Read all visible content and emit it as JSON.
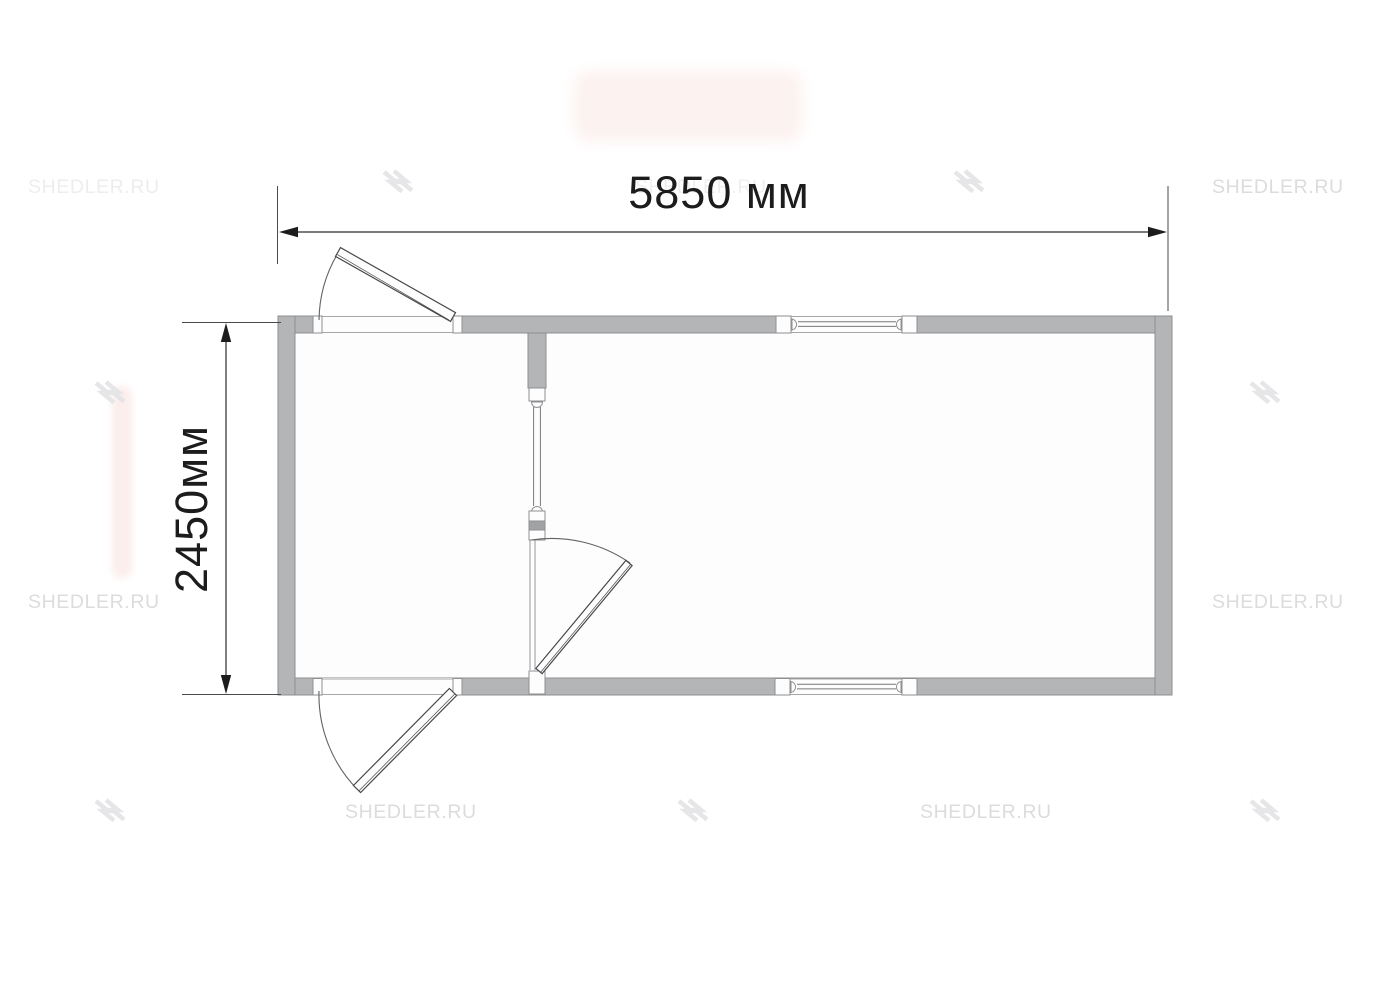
{
  "page": {
    "background_color": "#ffffff"
  },
  "watermark": {
    "text": "SHEDLER.RU",
    "text_color": "#dcdcdc",
    "logo_icon": "shedler-logo-icon",
    "logo_color": "#e4e4e6"
  },
  "dimensions": {
    "width_label": "5850 мм",
    "height_label": "2450мм",
    "color": "#1c1c1c"
  },
  "plan": {
    "wall_fill": "#b3b5b6",
    "wall_stroke": "#8e9092",
    "floor_fill": "#fdfdfd",
    "door_line_color": "#46484a",
    "arc_color": "#606264",
    "glazing_color": "#77797b",
    "rooms": [
      {
        "name": "left-room"
      },
      {
        "name": "right-room"
      }
    ],
    "exterior_door_count": 2,
    "interior_door_count": 1,
    "window_count": 2
  },
  "artifacts": {
    "top_patch_color": "#fcf2f0",
    "left_strip_color": "#fbedeb"
  }
}
